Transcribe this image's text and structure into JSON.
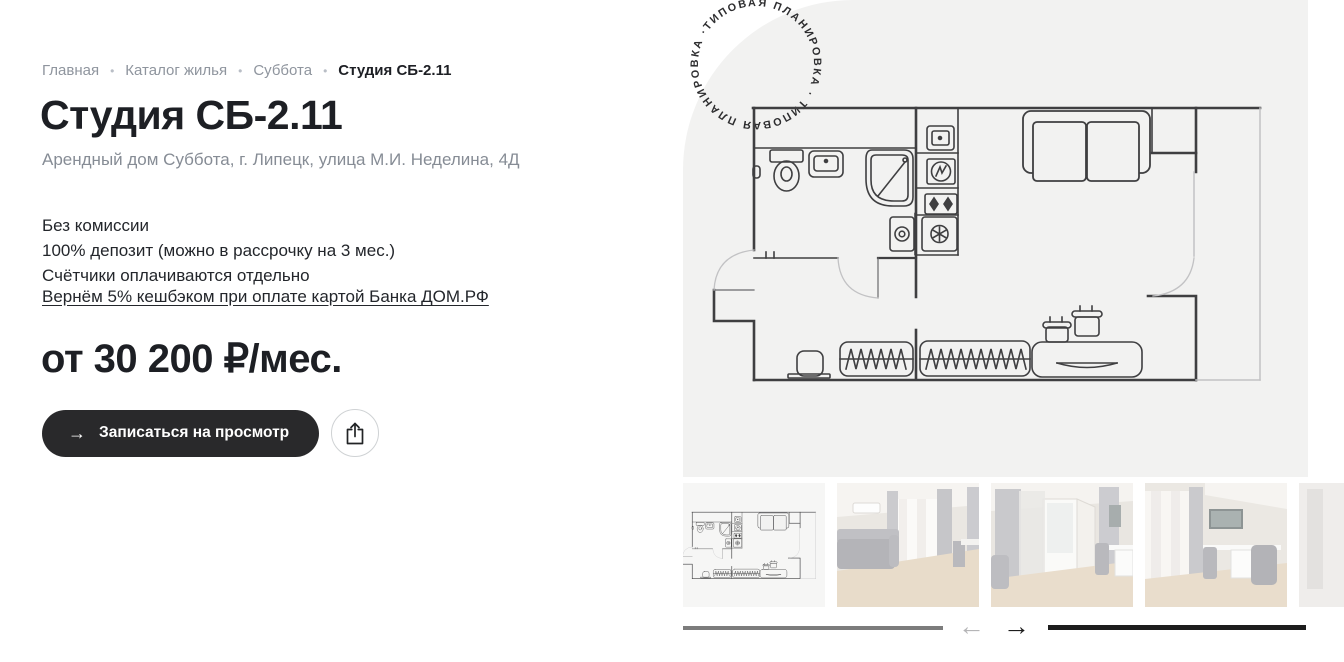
{
  "breadcrumb": {
    "separator": "•",
    "items": [
      {
        "label": "Главная"
      },
      {
        "label": "Каталог жилья"
      },
      {
        "label": "Суббота"
      },
      {
        "label": "Студия СБ-2.11"
      }
    ]
  },
  "listing": {
    "title": "Студия СБ-2.11",
    "subtitle": "Арендный дом Суббота, г. Липецк, улица М.И. Неделина, 4Д",
    "terms": [
      "Без комиссии",
      "100% депозит (можно в рассрочку на 3 мес.)",
      "Счётчики оплачиваются отдельно"
    ],
    "cashback_link": "Вернём 5% кешбэком при оплате картой Банка ДОМ.РФ",
    "price": "от 30 200 ₽/мес."
  },
  "actions": {
    "book_label": "Записаться на просмотр",
    "book_arrow": "→",
    "share_icon": "share-icon"
  },
  "plan": {
    "stamp_text": "ТИПОВАЯ ПЛАНИРОВКА · ТИПОВАЯ ПЛАНИРОВКА · ",
    "description": "floor-plan-drawing"
  },
  "gallery": {
    "thumbnails": [
      {
        "name": "floor-plan-thumbnail"
      },
      {
        "name": "photo-sofa-room"
      },
      {
        "name": "photo-balcony-door"
      },
      {
        "name": "photo-desk-room"
      },
      {
        "name": "photo-partial-next"
      }
    ],
    "prev_arrow": "←",
    "next_arrow": "→"
  },
  "colors": {
    "panel_bg": "#f2f2f1",
    "text_main": "#1d1f24",
    "text_muted": "#868c95",
    "button_bg": "#29292b",
    "plan_line": "#3f3f41"
  }
}
